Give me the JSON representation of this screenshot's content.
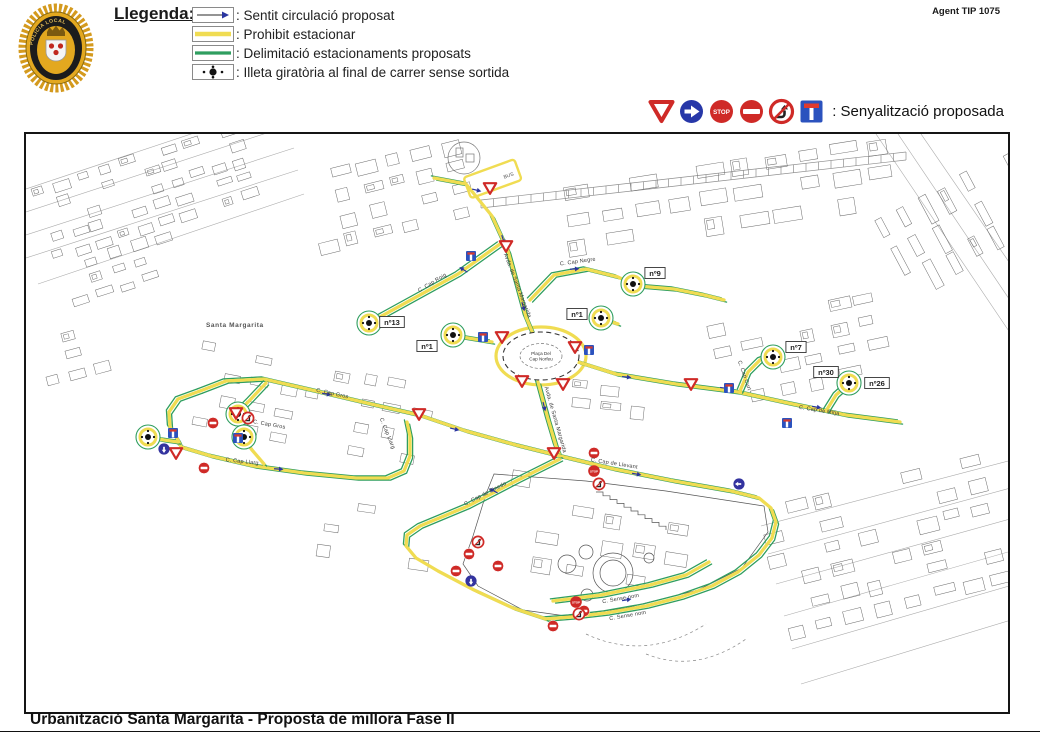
{
  "header": {
    "badge": {
      "ring_text": "POLICIA LOCAL"
    },
    "agent_ref": "Agent TIP 1075",
    "legend": {
      "title": "Llegenda:",
      "items": [
        {
          "icon": "direction-arrow",
          "label": ": Sentit circulació proposat"
        },
        {
          "icon": "yellow-line",
          "label": ": Prohibit estacionar"
        },
        {
          "icon": "green-line",
          "label": ": Delimitació estacionaments proposats"
        },
        {
          "icon": "roundabout-island",
          "label": ": Illeta giratòria al final de carrer sense sortida"
        }
      ]
    },
    "signage": {
      "label": ": Senyalització proposada",
      "icons": [
        "yield",
        "mandatory-right",
        "stop",
        "no-entry",
        "no-right-turn",
        "dead-end"
      ]
    }
  },
  "footer": {
    "title": "Urbanització Santa Margarita - Proposta de millora Fase II"
  },
  "map": {
    "area_label": "Santa Margarita",
    "bus_label": "BUS",
    "plaza": {
      "line1": "Plaça Del",
      "line2": "Cap Norfeu",
      "x": 515,
      "y": 222
    },
    "colors": {
      "no_parking_yellow": "#f0dc52",
      "parking_green": "#2f9e5f",
      "sign_red": "#cf2a27",
      "sign_blue": "#2b52be",
      "arrow_navy": "#2a35a0"
    },
    "street_labels": [
      {
        "text": "C. Cap Roig",
        "x": 407,
        "y": 150,
        "rot": -31
      },
      {
        "text": "C. Cap Negre",
        "x": 552,
        "y": 129,
        "rot": -8
      },
      {
        "text": "Avda. de Santa Margarida",
        "x": 490,
        "y": 152,
        "rot": 69
      },
      {
        "text": "Avda. de Santa Margarida",
        "x": 528,
        "y": 286,
        "rot": 74
      },
      {
        "text": "C. Cap Gros",
        "x": 306,
        "y": 261,
        "rot": 12
      },
      {
        "text": "C. Cap Gros",
        "x": 243,
        "y": 292,
        "rot": 10
      },
      {
        "text": "C. Cap Llarg",
        "x": 360,
        "y": 300,
        "rot": 68
      },
      {
        "text": "C. Cap Llarg",
        "x": 216,
        "y": 329,
        "rot": 6
      },
      {
        "text": "C. Cap de Llevant",
        "x": 588,
        "y": 331,
        "rot": 9
      },
      {
        "text": "C. Cap de Pinedo",
        "x": 460,
        "y": 361,
        "rot": -27
      },
      {
        "text": "C. Cap de Mitja",
        "x": 793,
        "y": 278,
        "rot": 9
      },
      {
        "text": "C. Cap Curt",
        "x": 717,
        "y": 242,
        "rot": 71
      },
      {
        "text": "C. Sense nom",
        "x": 595,
        "y": 466,
        "rot": -10
      },
      {
        "text": "C. Sense nom",
        "x": 602,
        "y": 483,
        "rot": -10
      }
    ],
    "number_labels": [
      {
        "text": "nº13",
        "x": 366,
        "y": 188
      },
      {
        "text": "nº1",
        "x": 401,
        "y": 212
      },
      {
        "text": "nº1",
        "x": 551,
        "y": 180
      },
      {
        "text": "nº9",
        "x": 629,
        "y": 139
      },
      {
        "text": "nº7",
        "x": 770,
        "y": 213
      },
      {
        "text": "nº30",
        "x": 800,
        "y": 238
      },
      {
        "text": "nº26",
        "x": 851,
        "y": 249
      }
    ],
    "islet_markers": [
      [
        343,
        189
      ],
      [
        427,
        201
      ],
      [
        575,
        184
      ],
      [
        607,
        150
      ],
      [
        747,
        223
      ],
      [
        823,
        249
      ],
      [
        212,
        280
      ],
      [
        218,
        303
      ],
      [
        122,
        303
      ]
    ],
    "signs": [
      {
        "type": "yield",
        "x": 464,
        "y": 54
      },
      {
        "type": "yield",
        "x": 480,
        "y": 112
      },
      {
        "type": "yield",
        "x": 393,
        "y": 280
      },
      {
        "type": "yield",
        "x": 476,
        "y": 203
      },
      {
        "type": "yield",
        "x": 549,
        "y": 213
      },
      {
        "type": "yield",
        "x": 496,
        "y": 247
      },
      {
        "type": "yield",
        "x": 537,
        "y": 250
      },
      {
        "type": "yield",
        "x": 528,
        "y": 319
      },
      {
        "type": "yield",
        "x": 665,
        "y": 250
      },
      {
        "type": "yield",
        "x": 210,
        "y": 279
      },
      {
        "type": "yield",
        "x": 150,
        "y": 319
      },
      {
        "type": "no-entry",
        "x": 187,
        "y": 289
      },
      {
        "type": "no-entry",
        "x": 178,
        "y": 334
      },
      {
        "type": "no-entry",
        "x": 568,
        "y": 319
      },
      {
        "type": "no-entry",
        "x": 430,
        "y": 437
      },
      {
        "type": "no-entry",
        "x": 472,
        "y": 432
      },
      {
        "type": "no-entry",
        "x": 527,
        "y": 492
      },
      {
        "type": "no-entry",
        "x": 443,
        "y": 420
      },
      {
        "type": "no-entry",
        "x": 558,
        "y": 477
      },
      {
        "type": "stop",
        "x": 568,
        "y": 337
      },
      {
        "type": "stop",
        "x": 550,
        "y": 468
      },
      {
        "type": "no-right-turn",
        "x": 222,
        "y": 284
      },
      {
        "type": "no-right-turn",
        "x": 573,
        "y": 350
      },
      {
        "type": "no-right-turn",
        "x": 452,
        "y": 408
      },
      {
        "type": "no-right-turn",
        "x": 553,
        "y": 480
      },
      {
        "type": "mandatory",
        "x": 713,
        "y": 350,
        "rot": 180
      },
      {
        "type": "mandatory",
        "x": 445,
        "y": 447,
        "rot": 90
      },
      {
        "type": "mandatory",
        "x": 138,
        "y": 315,
        "rot": 90
      },
      {
        "type": "dead-end",
        "x": 445,
        "y": 122
      },
      {
        "type": "dead-end",
        "x": 147,
        "y": 299
      },
      {
        "type": "dead-end",
        "x": 212,
        "y": 304
      },
      {
        "type": "dead-end",
        "x": 703,
        "y": 254
      },
      {
        "type": "dead-end",
        "x": 761,
        "y": 289
      },
      {
        "type": "dead-end",
        "x": 457,
        "y": 203
      },
      {
        "type": "dead-end",
        "x": 563,
        "y": 216
      }
    ],
    "routes": [
      {
        "points": [
          [
            408,
            44
          ],
          [
            440,
            50
          ],
          [
            466,
            82
          ],
          [
            482,
            117
          ],
          [
            500,
            183
          ],
          [
            508,
            202
          ]
        ]
      },
      {
        "points": [
          [
            474,
            110
          ],
          [
            432,
            140
          ],
          [
            352,
            184
          ]
        ]
      },
      {
        "points": [
          [
            466,
            208
          ],
          [
            436,
            203
          ]
        ]
      },
      {
        "points": [
          [
            504,
            166
          ],
          [
            528,
            141
          ],
          [
            560,
            135
          ],
          [
            592,
            143
          ],
          [
            606,
            150
          ]
        ]
      },
      {
        "points": [
          [
            612,
            152
          ],
          [
            648,
            155
          ],
          [
            678,
            161
          ],
          [
            698,
            166
          ]
        ]
      },
      {
        "points": [
          [
            592,
            190
          ],
          [
            580,
            186
          ]
        ]
      },
      {
        "points": [
          [
            552,
            228
          ],
          [
            590,
            240
          ],
          [
            650,
            250
          ],
          [
            712,
            258
          ],
          [
            762,
            269
          ],
          [
            820,
            281
          ],
          [
            874,
            288
          ]
        ]
      },
      {
        "points": [
          [
            714,
            257
          ],
          [
            722,
            238
          ],
          [
            734,
            226
          ],
          [
            744,
            222
          ]
        ]
      },
      {
        "points": [
          [
            800,
            277
          ],
          [
            810,
            261
          ],
          [
            820,
            252
          ]
        ]
      },
      {
        "points": [
          [
            512,
            248
          ],
          [
            522,
            285
          ],
          [
            530,
            312
          ],
          [
            534,
            322
          ]
        ]
      },
      {
        "points": [
          [
            534,
            322
          ],
          [
            588,
            335
          ],
          [
            648,
            347
          ],
          [
            705,
            357
          ],
          [
            733,
            364
          ],
          [
            745,
            374
          ],
          [
            750,
            388
          ],
          [
            746,
            404
          ],
          [
            733,
            421
          ],
          [
            712,
            438
          ],
          [
            686,
            452
          ],
          [
            655,
            463
          ],
          [
            620,
            472
          ],
          [
            580,
            479
          ],
          [
            545,
            483
          ],
          [
            520,
            485
          ]
        ]
      },
      {
        "points": [
          [
            534,
            325
          ],
          [
            492,
            346
          ],
          [
            442,
            372
          ],
          [
            394,
            392
          ],
          [
            381,
            401
          ],
          [
            380,
            412
          ],
          [
            390,
            424
          ],
          [
            412,
            437
          ],
          [
            448,
            456
          ],
          [
            487,
            474
          ],
          [
            520,
            485
          ]
        ]
      },
      {
        "points": [
          [
            527,
            467
          ],
          [
            575,
            461
          ],
          [
            624,
            451
          ],
          [
            660,
            441
          ],
          [
            683,
            428
          ]
        ]
      },
      {
        "points": [
          [
            174,
            257
          ],
          [
            200,
            247
          ],
          [
            238,
            245
          ],
          [
            290,
            257
          ],
          [
            345,
            270
          ],
          [
            393,
            281
          ],
          [
            440,
            297
          ],
          [
            490,
            311
          ],
          [
            534,
            322
          ]
        ]
      },
      {
        "points": [
          [
            174,
            257
          ],
          [
            152,
            265
          ],
          [
            143,
            278
          ],
          [
            144,
            293
          ],
          [
            152,
            306
          ],
          [
            155,
            313
          ],
          [
            185,
            322
          ],
          [
            228,
            332
          ],
          [
            278,
            339
          ],
          [
            330,
            344
          ],
          [
            362,
            344
          ],
          [
            378,
            337
          ],
          [
            384,
            322
          ],
          [
            384,
            302
          ],
          [
            381,
            288
          ]
        ]
      },
      {
        "points": [
          [
            152,
            308
          ],
          [
            138,
            306
          ],
          [
            128,
            304
          ]
        ]
      },
      {
        "points": [
          [
            240,
            249
          ],
          [
            224,
            266
          ],
          [
            216,
            274
          ]
        ]
      },
      {
        "points": [
          [
            238,
            330
          ],
          [
            226,
            316
          ],
          [
            221,
            309
          ]
        ]
      }
    ],
    "arrows": [
      [
        450,
        56,
        14
      ],
      [
        477,
        105,
        72
      ],
      [
        497,
        172,
        74
      ],
      [
        438,
        136,
        -148
      ],
      [
        548,
        135,
        -4
      ],
      [
        600,
        243,
        6
      ],
      [
        698,
        254,
        8
      ],
      [
        790,
        273,
        10
      ],
      [
        518,
        272,
        76
      ],
      [
        610,
        340,
        10
      ],
      [
        468,
        357,
        -152
      ],
      [
        300,
        260,
        11
      ],
      [
        428,
        295,
        13
      ],
      [
        252,
        335,
        4
      ],
      [
        600,
        466,
        -10
      ]
    ]
  }
}
